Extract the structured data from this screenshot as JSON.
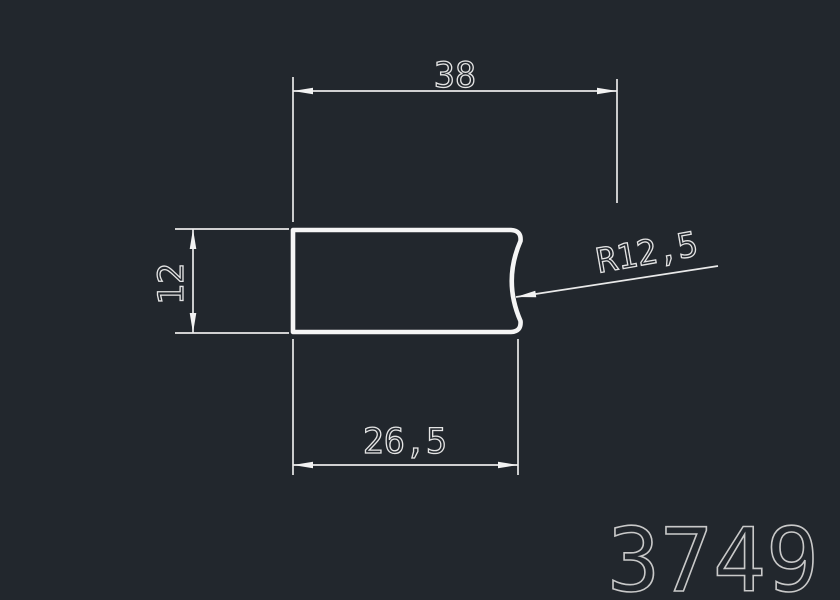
{
  "canvas": {
    "background_color": "#22272d",
    "geometry_line_color": "#f5f5f5",
    "dimension_line_color": "#e9e9e9",
    "dimension_text_color": "#e4e4e4",
    "part_number_color": "#c9c9c9"
  },
  "drawing": {
    "type": "cad-profile-drawing",
    "part_number": "3749",
    "dimensions": {
      "overall_width": {
        "label": "38",
        "value": 38
      },
      "height": {
        "label": "12",
        "value": 12
      },
      "partial_width": {
        "label": "26,5",
        "value": 26.5
      },
      "radius": {
        "label": "R12,5",
        "value": 12.5
      }
    }
  }
}
